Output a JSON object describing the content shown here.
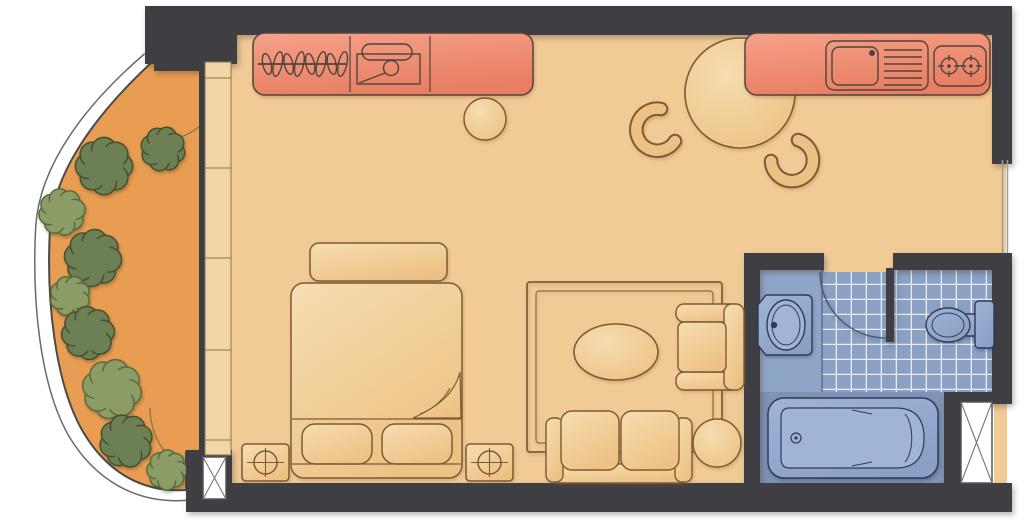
{
  "title": "Hotel guest room floor plan",
  "colors": {
    "wall": "#3f3e43",
    "floor": "#f1cb96",
    "balcony": "#e99d52",
    "frame": "#f3d5a6",
    "frame_line": "#8a7550",
    "unit_light": "#f5a189",
    "unit_dark": "#e87f62",
    "unit_border": "#4f4440",
    "furn_light": "#f7ddb0",
    "furn_dark": "#ecc284",
    "furn_line": "#7d5b35",
    "bath_tile": "#8aa1c4",
    "bath_vanity": "#8fa6c9",
    "bath_tub_zone": "#7e93b6",
    "fixture_light": "#9fb4d7",
    "fixture_dark": "#8aa1c6",
    "fixture_line": "#2e3c57",
    "tile_line": "#eef2f8",
    "tree_dark": "#6d7f54",
    "tree_dark_line": "#454f2e",
    "tree_light": "#8c9c66",
    "tree_light_line": "#5a6a3c",
    "rug_line": "#8a6a42",
    "arc": "#8a7550",
    "bath_arc": "#4a5568",
    "shaft_line": "#6a6a6a",
    "white": "#ffffff"
  },
  "balcony": {
    "doors": 2,
    "bushes": [
      {
        "x": 104,
        "y": 166,
        "r": 27,
        "shade": "dark"
      },
      {
        "x": 163,
        "y": 149,
        "r": 21,
        "shade": "dark"
      },
      {
        "x": 62,
        "y": 212,
        "r": 22,
        "shade": "light"
      },
      {
        "x": 93,
        "y": 258,
        "r": 27,
        "shade": "dark"
      },
      {
        "x": 70,
        "y": 296,
        "r": 19,
        "shade": "light"
      },
      {
        "x": 88,
        "y": 333,
        "r": 25,
        "shade": "dark"
      },
      {
        "x": 112,
        "y": 389,
        "r": 28,
        "shade": "light"
      },
      {
        "x": 126,
        "y": 441,
        "r": 25,
        "shade": "dark"
      },
      {
        "x": 167,
        "y": 470,
        "r": 19,
        "shade": "light"
      }
    ]
  },
  "kitchen": {
    "items": [
      "wardrobe-with-hangers",
      "safe",
      "counter",
      "sink-with-drainer",
      "stove-two-burners"
    ],
    "hangers": {
      "count": 8,
      "style": "coat-hangers"
    },
    "burners": 2
  },
  "dining": {
    "items": [
      "round-table",
      "chair",
      "chair",
      "stool"
    ],
    "chairs": 2
  },
  "sleeping": {
    "items": [
      "double-bed",
      "pillow",
      "pillow",
      "foot-bench",
      "nightstand-lamp",
      "nightstand-lamp"
    ],
    "pillows": 2,
    "nightstands": 2
  },
  "living": {
    "items": [
      "rug",
      "oval-coffee-table",
      "armchair",
      "two-seat-sofa",
      "round-side-table"
    ]
  },
  "bathroom": {
    "items": [
      "washbasin",
      "toilet",
      "bathtub",
      "swing-door",
      "tiled-floor",
      "duct-shaft"
    ]
  },
  "shafts": 2,
  "windows": {
    "balcony_glazing_panels": 5,
    "right_wall_window": 1
  }
}
